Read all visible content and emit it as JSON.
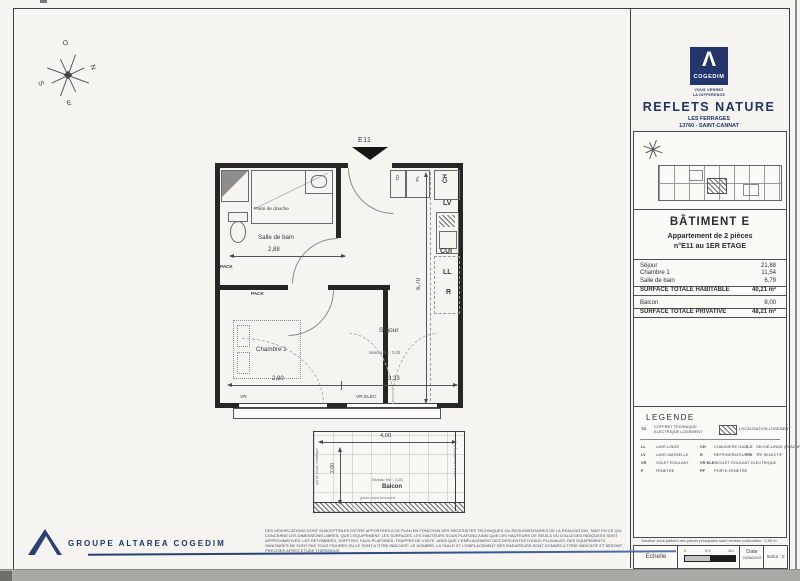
{
  "header": {
    "logo_glyph": "Λ",
    "brand": "COGEDIM",
    "tagline1": "VOUS VERREZ",
    "tagline2": "LA DIFFERENCE",
    "project": "REFLETS NATURE",
    "address1": "LES FERRAGES",
    "address2": "13760 - SAINT-CANNAT",
    "navy": "#1f3368"
  },
  "title_block": {
    "building": "BÂTIMENT E",
    "apartment": "Appartement de 2 pièces",
    "unit": "n°E11 au 1ER ETAGE"
  },
  "surfaces": {
    "rows": [
      {
        "label": "Séjour",
        "value": "21,88"
      },
      {
        "label": "Chambre 1",
        "value": "11,54"
      },
      {
        "label": "Salle de bain",
        "value": "6,79"
      }
    ],
    "habitable": {
      "label": "SURFACE TOTALE HABITABLE",
      "value": "40,21 m²"
    },
    "balcon": {
      "label": "Balcon",
      "value": "8,00"
    },
    "privative": {
      "label": "SURFACE TOTALE PRIVATIVE",
      "value": "48,21 m²"
    }
  },
  "legend": {
    "title": "LEGENDE",
    "td": {
      "abbr": "TD",
      "label": "COFFRET TECHNIQUE ELECTRIQUE LOGEMENT"
    },
    "hatch_label": "LOCALISATION LOGEMENT",
    "entries": [
      {
        "abbr": "LL",
        "label": "LAVE-LINGE"
      },
      {
        "abbr": "CH",
        "label": "CHAUDIERE GAZ"
      },
      {
        "abbr": "S.C",
        "label": "SECHE-LINGE (PLACARD)"
      },
      {
        "abbr": "LV",
        "label": "LAVE-VAISSELLE"
      },
      {
        "abbr": "R",
        "label": "REFRIGERATEUR"
      },
      {
        "abbr": "TRI",
        "label": "TRI SELECTIF"
      },
      {
        "abbr": "VR",
        "label": "VOLET ROULANT"
      },
      {
        "abbr": "VR ELEC",
        "label": "VOLET ROULANT ELECTRIQUE"
      },
      {
        "abbr": "F",
        "label": "FENETRE"
      },
      {
        "abbr": "PF",
        "label": "PORTE-FENETRE"
      }
    ]
  },
  "scalebox": {
    "note": "Hauteur sous plafond des pièces principales sauf mention particulière : 2,50 m",
    "scale_label": "Echelle",
    "tick0": "0",
    "tick1": "0,5",
    "tick2": "1m",
    "date_label": "Date",
    "date_value": "24/06/2019",
    "indice": "Indice : 0"
  },
  "footer": {
    "group": "GROUPE ALTAREA COGEDIM",
    "disclaimer": "DES MODIFICATIONS SONT SUSCEPTIBLES D'ETRE APPORTEES A CE PLAN EN FONCTION DES NECESSITES TECHNIQUES OU REGLEMENTAIRES DE LA REALISATION, TANT EN CE QUI CONCERNE LES DIMENSIONS LIBRES, QUE L'EQUIPEMENT. LES SURFACES, LES HAUTEURS SOUS PLAFOND AINSI QUE LES HAUTEURS DE SEUILS OU D'ALLEGES INDIQUEES SONT APPROXIMATIVES. LES RETOMBEES, SOFFITES, FAUX-PLAFONDS, TRAPPES DE VISITE, AINSI QUE L'EMPLACEMENT DES DESCENTES D'EAUX PLUVIALES, DES EQUIPEMENTS SANITAIRES NE SONT PAS TOUS FIGURES OU LE SONT A TITRE INDICATIF. LE NOMBRE, LA TAILLE ET L'EMPLACEMENT DES RADIATEURS SONT DONNES A TITRE INDICATIF ET SERONT PRECISES APRES ETUDE THERMIQUE."
  },
  "plan": {
    "entry_label": "E11",
    "rooms": {
      "bathroom": "Salle de bain",
      "bedroom": "Chambre 1",
      "living": "Séjour",
      "living_level": "Niveau fini : 0,00",
      "balcony": "Balcon",
      "balcony_level": "Niveau fini : -0,02"
    },
    "labels": {
      "shower": "Paroi de douche",
      "pack": "PACK",
      "td": "TD",
      "pl": "PL",
      "ch": "CH",
      "lv": "LV",
      "cui": "CUI",
      "ll": "LL",
      "r": "R",
      "vr": "VR",
      "f": "F",
      "sill": "Appui 100cm",
      "vr_elec": "VR ELEC",
      "pf": "PF",
      "guard_left": "garde-corps métallique",
      "guard_right": "brise vue métallique",
      "guard_bottom": "garde-corps serrurerie"
    },
    "dims": {
      "bath_width": "2,88",
      "bedroom_width": "2,80",
      "living_width": "3,33",
      "depth": "6,70",
      "balcony_width": "4,00",
      "balcony_depth": "2,00"
    },
    "compass": {
      "n": "N",
      "s": "S",
      "e": "E",
      "o": "O"
    }
  }
}
